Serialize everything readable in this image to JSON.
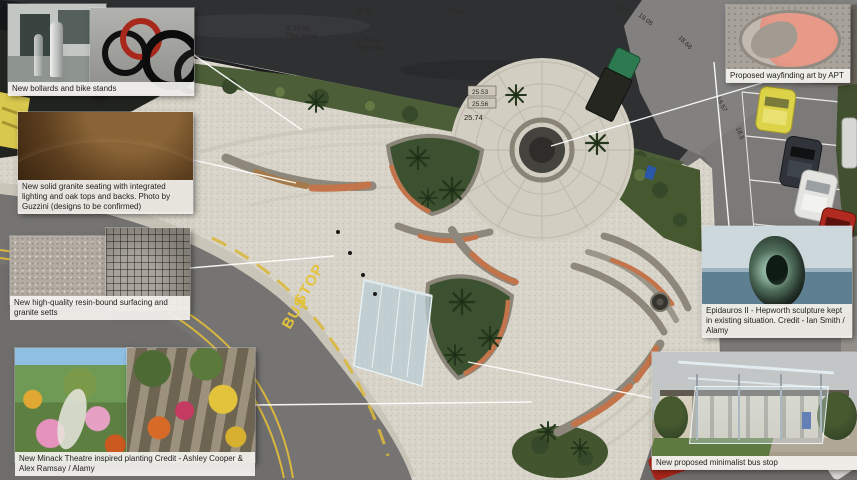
{
  "callouts": {
    "bollards": {
      "caption": "New bollards and bike stands"
    },
    "seating": {
      "caption": "New solid granite seating with integrated lighting and oak tops and backs. Photo by Guzzini (designs to be confirmed)"
    },
    "paving": {
      "caption": "New high-quality resin-bound surfacing and granite setts"
    },
    "planting": {
      "caption": "New Minack Theatre inspired planting Credit - Ashley Cooper & Alex Ramsay / Alamy"
    },
    "wayfinding": {
      "caption": "Proposed wayfinding art by APT"
    },
    "sculpture": {
      "caption": "Epidauros II - Hepworth sculpture kept in existing situation. Credit - Ian Smith / Alamy"
    },
    "bus_stop": {
      "caption": "New proposed minimalist bus stop"
    }
  },
  "plan": {
    "road_marking": {
      "line1": "BUS",
      "line2": "STOP"
    },
    "levels": {
      "a": "20.53",
      "b": "20.01",
      "pipe1_l1": "IL 20.50",
      "pipe1_l2": "Pipe Invert",
      "pipe2_l1": "IL 25.42",
      "pipe2_l2": "Pipe Invert",
      "c": "25.53",
      "d": "25.56",
      "e": "25.74",
      "f": "18.19",
      "g": "19.05",
      "h": "18.66",
      "i": "18.57",
      "j": "18.5"
    }
  },
  "colors": {
    "accent_terracotta": "#c4744a",
    "road_yellow": "#d9b73e",
    "leader_line": "#ffffff",
    "planting_green": "#3c5130",
    "paving_light": "#d8d4c9",
    "asphalt_dark": "#2f3032"
  }
}
